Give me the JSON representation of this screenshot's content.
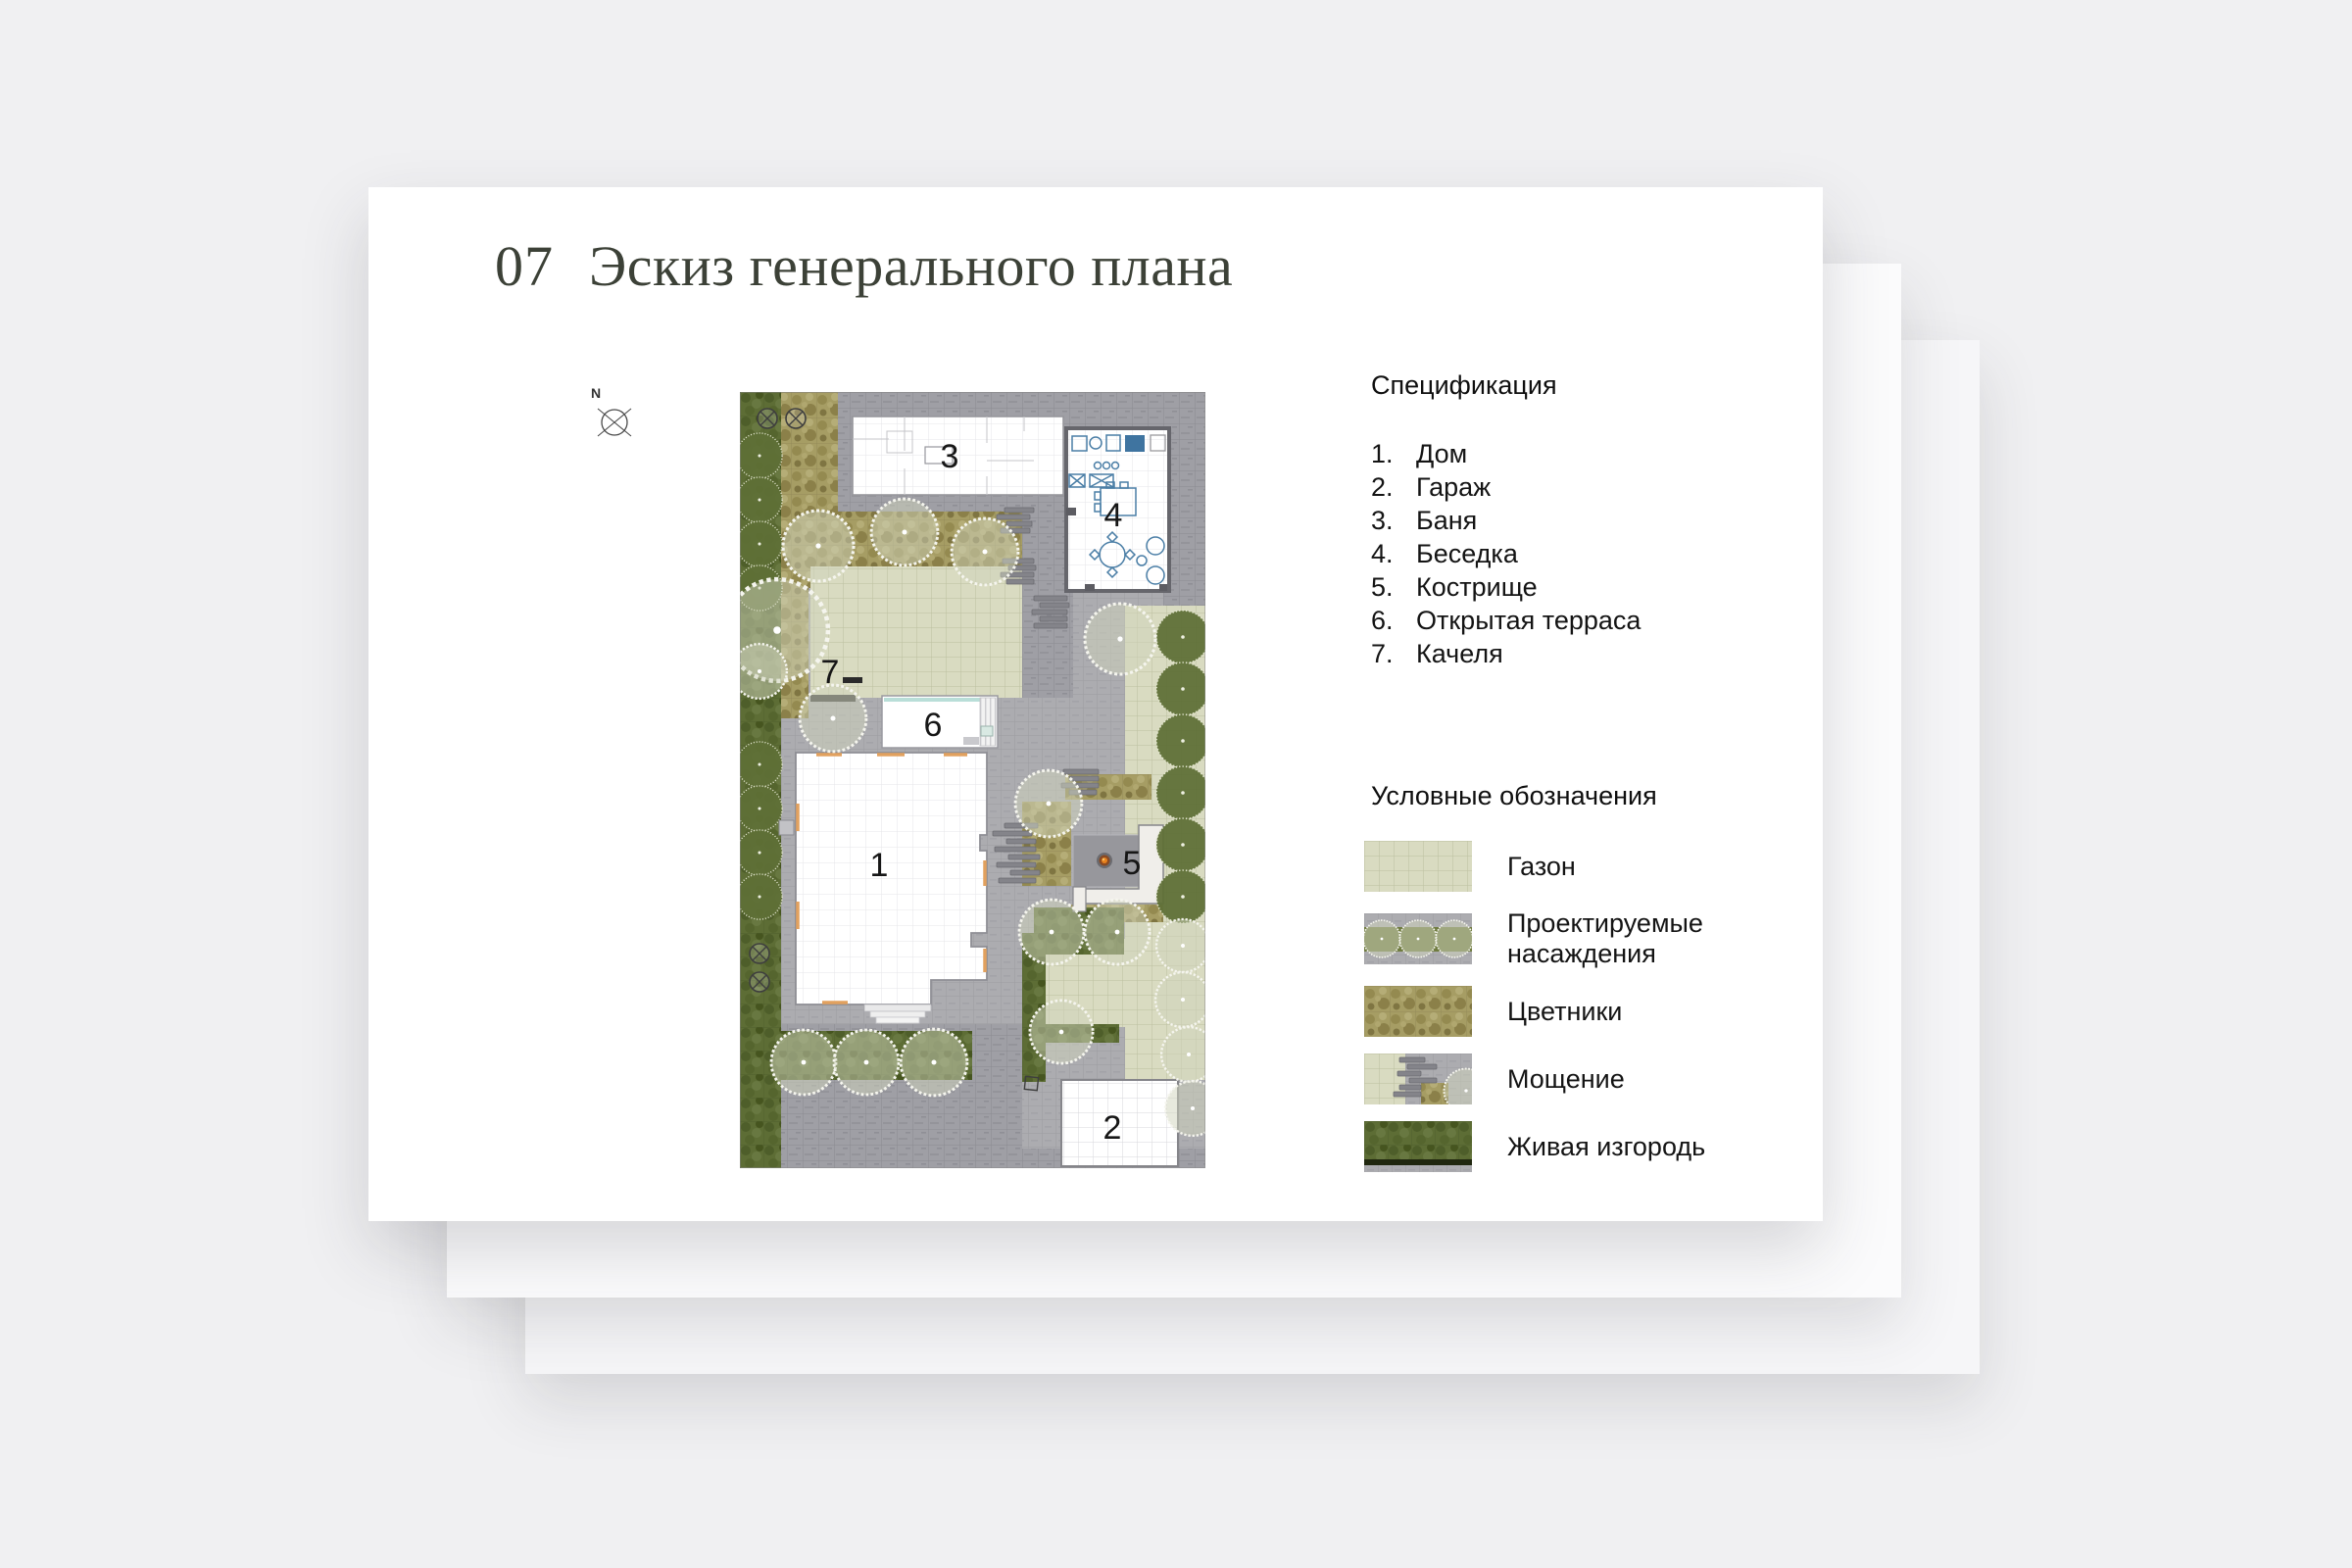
{
  "slide": {
    "number": "07",
    "title": "Эскиз генерального плана"
  },
  "compass": {
    "north": "N"
  },
  "specification": {
    "heading": "Спецификация",
    "items": [
      {
        "num": "1.",
        "label": "Дом"
      },
      {
        "num": "2.",
        "label": "Гараж"
      },
      {
        "num": "3.",
        "label": "Баня"
      },
      {
        "num": "4.",
        "label": "Беседка"
      },
      {
        "num": "5.",
        "label": "Кострище"
      },
      {
        "num": "6.",
        "label": "Открытая терраса"
      },
      {
        "num": "7.",
        "label": "Качеля"
      }
    ]
  },
  "legend": {
    "heading": "Условные обозначения",
    "items": [
      {
        "id": "lawn",
        "label": "Газон"
      },
      {
        "id": "plantings",
        "label": "Проектируемые насаждения"
      },
      {
        "id": "flowerbeds",
        "label": "Цветники"
      },
      {
        "id": "paving",
        "label": "Мощение"
      },
      {
        "id": "hedge",
        "label": "Живая изгородь"
      }
    ]
  },
  "plan": {
    "labels": {
      "house": "1",
      "garage": "2",
      "bathhouse": "3",
      "gazebo": "4",
      "fire_pit": "5",
      "terrace": "6",
      "swing": "7"
    }
  },
  "colors": {
    "background": "#f0f0f2",
    "card": "#ffffff",
    "title_text": "#3c4137",
    "body_text": "#141414",
    "paving": "#acacb0",
    "lawn": "#d9dbc1",
    "flowerbed": "#a69d64",
    "hedge": "#5d6d35",
    "furniture_blue": "#4a7ea6",
    "house_accent": "#e2a15e"
  }
}
